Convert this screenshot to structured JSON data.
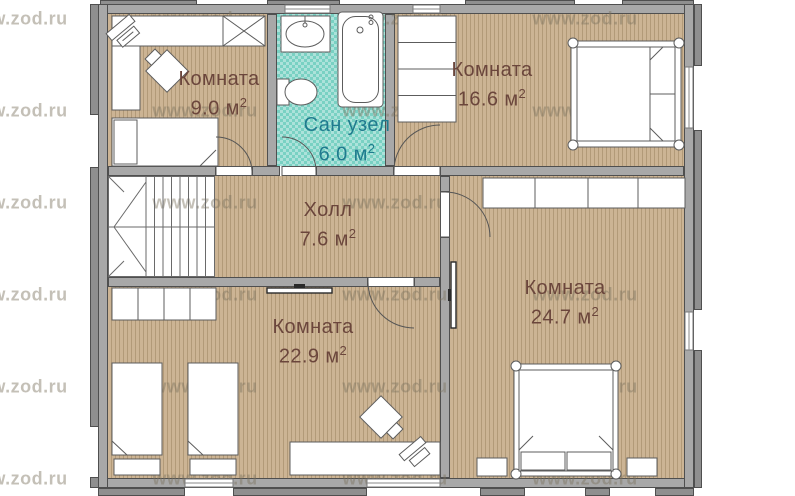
{
  "watermark": {
    "text": "www.zod.ru",
    "columns_x": [
      15,
      205,
      395,
      585
    ],
    "rows_y": [
      19,
      111,
      203,
      295,
      387,
      479
    ]
  },
  "colors": {
    "wall": "#a8a8a8",
    "wall_border": "#4f4f4f",
    "pier": "#8f8f8f",
    "floor_wood": "#ccb494",
    "floor_wood_stripe": "#b29a78",
    "floor_bath": "#79d1c3",
    "furniture_line": "#5c5c5c",
    "label_room": "#6b463c",
    "label_bath": "#1f7b8e",
    "watermark_color": "rgba(125,115,95,0.45)"
  },
  "rooms": [
    {
      "id": "room-9",
      "name": "Комната",
      "area_value": "9.0",
      "area_unit": "м",
      "area_sup": "2"
    },
    {
      "id": "san-uzel",
      "name": "Сан узел",
      "area_value": "6.0",
      "area_unit": "м",
      "area_sup": "2"
    },
    {
      "id": "room-16-6",
      "name": "Комната",
      "area_value": "16.6",
      "area_unit": "м",
      "area_sup": "2"
    },
    {
      "id": "hall",
      "name": "Холл",
      "area_value": "7.6",
      "area_unit": "м",
      "area_sup": "2"
    },
    {
      "id": "room-22-9",
      "name": "Комната",
      "area_value": "22.9",
      "area_unit": "м",
      "area_sup": "2"
    },
    {
      "id": "room-24-7",
      "name": "Комната",
      "area_value": "24.7",
      "area_unit": "м",
      "area_sup": "2"
    }
  ]
}
